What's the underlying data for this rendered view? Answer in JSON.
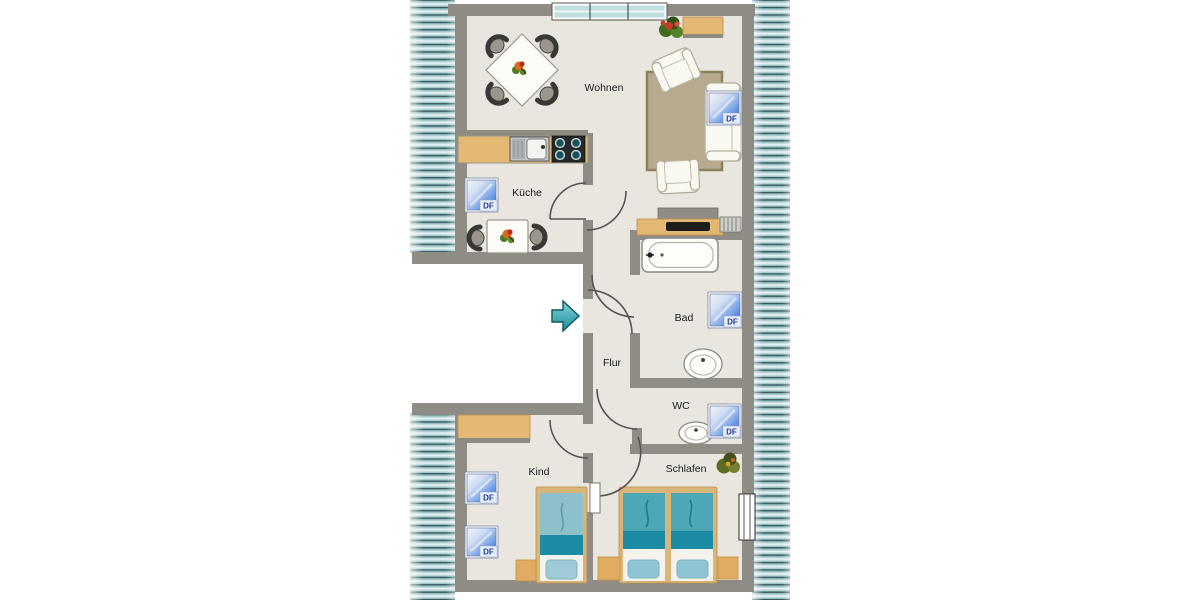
{
  "plan_title": "floor-plan",
  "rooms": {
    "wohnen": "Wohnen",
    "kueche": "Küche",
    "bad": "Bad",
    "flur": "Flur",
    "wc": "WC",
    "kind": "Kind",
    "schlafen": "Schlafen"
  },
  "df_label": "DF",
  "palette": {
    "wall": "#8e8c84",
    "floor": "#e9e6df",
    "roof_hatch_teal": "#9cc4c7",
    "furniture_tan": "#e2b873",
    "bed_teal_dark": "#1b8ca4",
    "bed_teal_light": "#8ec0cc",
    "df_window_blue": "#2f63c8",
    "entrance_arrow_teal": "#1f8b9a",
    "carpet": "#b7aa8e"
  }
}
